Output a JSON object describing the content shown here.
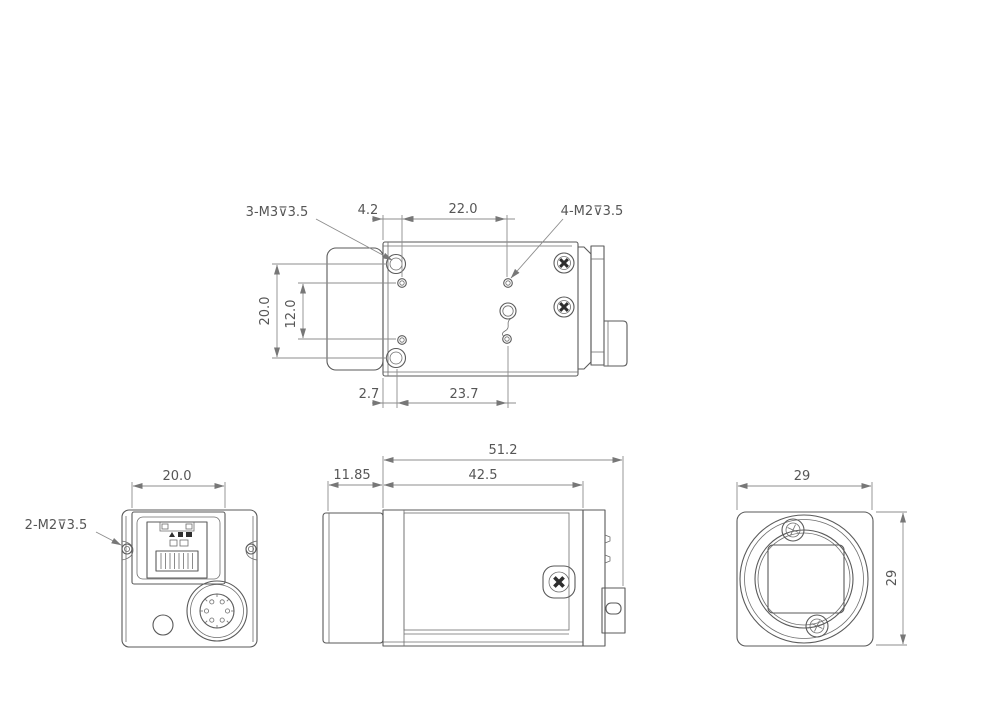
{
  "meta": {
    "drawing_type": "camera dimensional drawing",
    "background_color": "#ffffff",
    "object_line_color": "#5a5a5a",
    "dimension_line_color": "#8c8c8c",
    "text_color": "#565656"
  },
  "views": {
    "top_view": {
      "label_m3_holes": "3-M3⊽3.5",
      "label_m2_holes": "4-M2⊽3.5",
      "dim_hole_inset": "4.2",
      "dim_hole_pitch": "22.0",
      "dim_height_outer": "20.0",
      "dim_height_inner": "12.0",
      "dim_front_offset": "2.7",
      "dim_length_pitch": "23.7"
    },
    "back_view": {
      "dim_connector_width": "20.0",
      "label_m2_holes": "2-M2⊽3.5"
    },
    "side_view": {
      "dim_total_length": "51.2",
      "dim_body_length": "42.5",
      "dim_lens_length": "11.85"
    },
    "front_view": {
      "dim_width": "29",
      "dim_height": "29"
    }
  }
}
